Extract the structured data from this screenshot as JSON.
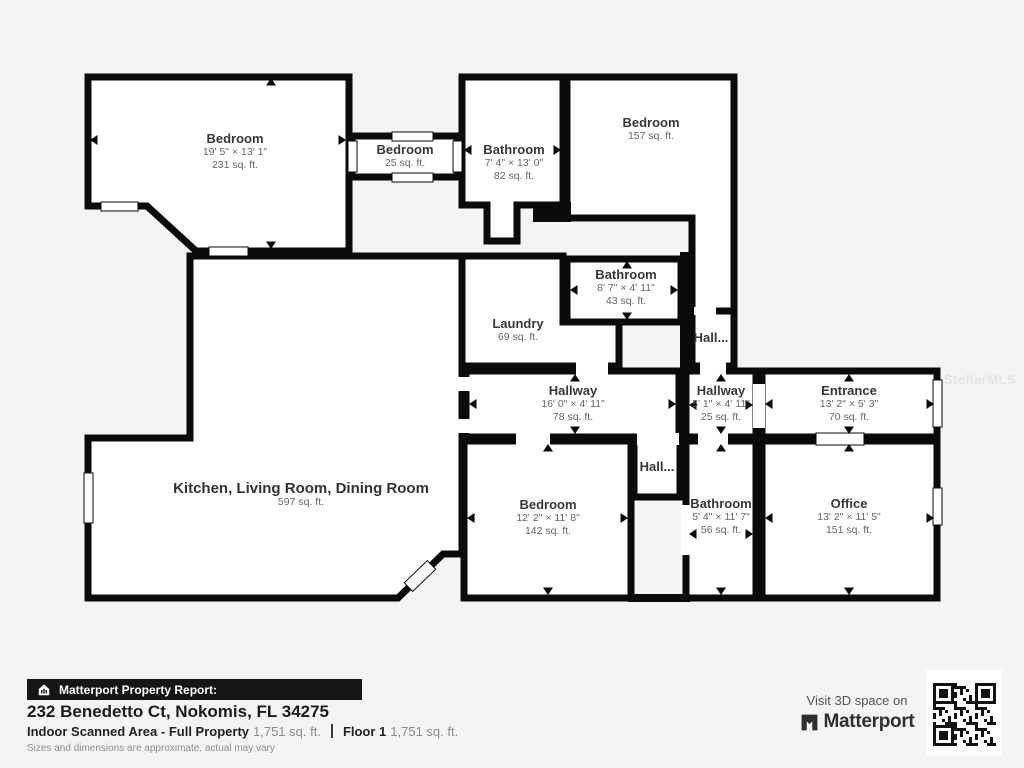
{
  "watermark": "StellarMLS",
  "rooms": [
    {
      "name": "Bedroom",
      "dims": "19' 5\" × 13' 1\"",
      "area": "231 sq. ft."
    },
    {
      "name": "Bedroom",
      "dims": "",
      "area": "25 sq. ft."
    },
    {
      "name": "Bathroom",
      "dims": "7' 4\" × 13' 0\"",
      "area": "82 sq. ft."
    },
    {
      "name": "Bedroom",
      "dims": "",
      "area": "157 sq. ft."
    },
    {
      "name": "Bathroom",
      "dims": "8' 7\" × 4' 11\"",
      "area": "43 sq. ft."
    },
    {
      "name": "Laundry",
      "dims": "",
      "area": "69 sq. ft."
    },
    {
      "name": "Hall...",
      "dims": "",
      "area": ""
    },
    {
      "name": "Hallway",
      "dims": "16' 0\" × 4' 11\"",
      "area": "78 sq. ft."
    },
    {
      "name": "Hallway",
      "dims": "5' 1\" × 4' 11\"",
      "area": "25 sq. ft."
    },
    {
      "name": "Entrance",
      "dims": "13' 2\" × 5' 3\"",
      "area": "70 sq. ft."
    },
    {
      "name": "Kitchen, Living Room, Dining Room",
      "dims": "",
      "area": "597 sq. ft."
    },
    {
      "name": "Bedroom",
      "dims": "12' 2\" × 11' 8\"",
      "area": "142 sq. ft."
    },
    {
      "name": "Hall...",
      "dims": "",
      "area": ""
    },
    {
      "name": "Bathroom",
      "dims": "5' 4\" × 11' 7\"",
      "area": "56 sq. ft."
    },
    {
      "name": "Office",
      "dims": "13' 2\" × 11' 5\"",
      "area": "151 sq. ft."
    }
  ],
  "footer": {
    "report_label": "Matterport Property Report:",
    "address": "232 Benedetto Ct, Nokomis, FL 34275",
    "scanned_label": "Indoor Scanned Area - Full Property",
    "scanned_value": "1,751 sq. ft.",
    "floor_label": "Floor 1",
    "floor_value": "1,751 sq. ft.",
    "disclaimer": "Sizes and dimensions are approximate, actual may vary",
    "visit_text": "Visit 3D space on",
    "brand": "Matterport"
  },
  "colors": {
    "wall": "#0a0a0a",
    "room_fill": "#ffffff",
    "background": "#f4f4f4",
    "ribbon": "#161616"
  }
}
